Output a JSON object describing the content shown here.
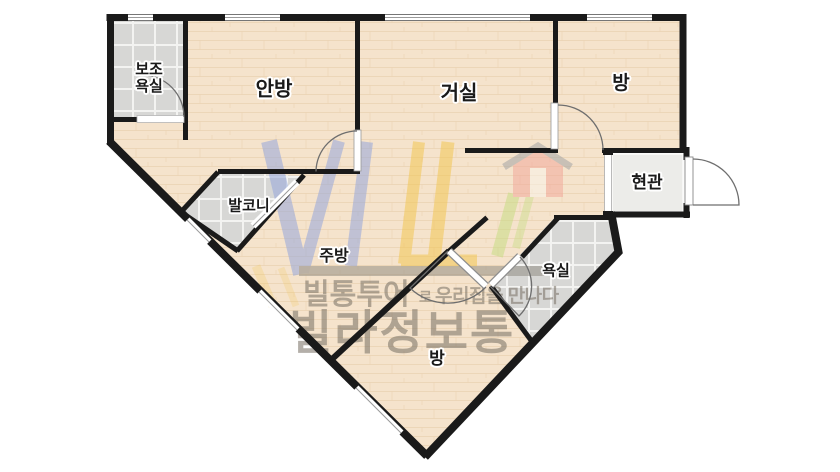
{
  "plan": {
    "rooms": {
      "aux_bathroom": {
        "label": "보조욕실"
      },
      "master_bedroom": {
        "label": "안방"
      },
      "living_room": {
        "label": "거실"
      },
      "bedroom_right": {
        "label": "방"
      },
      "entrance": {
        "label": "현관"
      },
      "balcony": {
        "label": "발코니"
      },
      "kitchen": {
        "label": "주방"
      },
      "bathroom": {
        "label": "욕실"
      },
      "bedroom_bottom": {
        "label": "방"
      }
    }
  },
  "watermark": {
    "logo_icon": "vil-house-logo",
    "logo_text": "VIL",
    "tagline_part1": "빌통투어",
    "tagline_part2": "로",
    "tagline_part3": "우리집을 만나다",
    "brand_name": "빌라정보통"
  },
  "colors": {
    "wall": "#1a1a1a",
    "floor": "#f5e3cc",
    "floor_line": "#e7cfae",
    "tile": "#d7d7d5",
    "tile_line": "#f3f3f1",
    "entrance_floor": "#ecece9",
    "logo_blue": "#96a7db",
    "logo_yellow": "#f2c654",
    "logo_green": "#c8dc85",
    "logo_salmon": "#f3a99b",
    "roof_gray": "#a5a5a5",
    "watermark_text": "#776f63",
    "watermark_bar": "#8a857b",
    "arc_gray": "#6e6e6e",
    "label_color": "#1a1a1a"
  }
}
